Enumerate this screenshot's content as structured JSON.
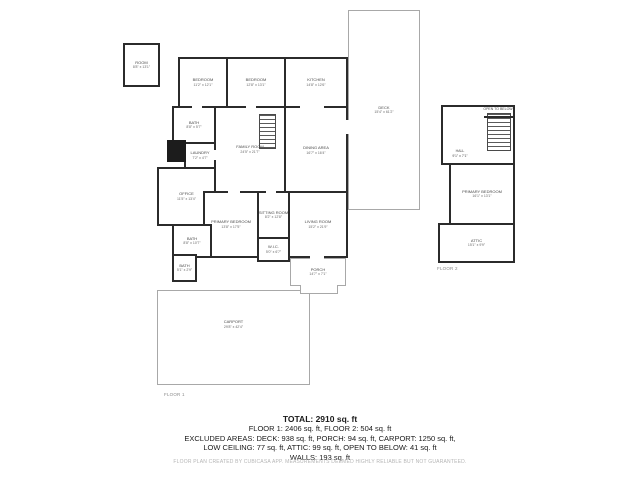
{
  "plan": {
    "floor1_label": "FLOOR 1",
    "floor2_label": "FLOOR 2",
    "rooms": {
      "detached_room": {
        "name": "ROOM",
        "dims": "8'8\" x 13'1\""
      },
      "bedroom_west": {
        "name": "BEDROOM",
        "dims": "11'2\" x 12'1\""
      },
      "bedroom_center": {
        "name": "BEDROOM",
        "dims": "12'8\" x 13'1\""
      },
      "kitchen": {
        "name": "KITCHEN",
        "dims": "14'8\" x 12'6\""
      },
      "bath_top": {
        "name": "BATH",
        "dims": "8'8\" x 5'7\""
      },
      "laundry": {
        "name": "LAUNDRY",
        "dims": "7'2\" x 4'7\""
      },
      "office": {
        "name": "OFFICE",
        "dims": "11'5\" x 13'4\""
      },
      "family_room": {
        "name": "FAMILY ROOM",
        "dims": "24'5\" x 21'7\""
      },
      "dining_area": {
        "name": "DINING AREA",
        "dims": "16'7\" x 16'4\""
      },
      "primary_bedroom": {
        "name": "PRIMARY BEDROOM",
        "dims": "13'8\" x 17'5\""
      },
      "sitting_room": {
        "name": "SITTING ROOM",
        "dims": "8'2\" x 12'8\""
      },
      "wic": {
        "name": "W.I.C.",
        "dims": "5'0\" x 6'7\""
      },
      "living_room": {
        "name": "LIVING ROOM",
        "dims": "15'2\" x 21'9\""
      },
      "bath_lower": {
        "name": "BATH",
        "dims": "8'8\" x 10'7\""
      },
      "bath_small": {
        "name": "BATH",
        "dims": "5'1\" x 2'9\""
      },
      "porch": {
        "name": "PORCH",
        "dims": "14'7\" x 7'1\""
      },
      "carport": {
        "name": "CARPORT",
        "dims": "29'8\" x 42'4\""
      },
      "deck": {
        "name": "DECK",
        "dims": "15'4\" x 61'2\""
      },
      "open_to_below": {
        "name": "OPEN TO BELOW",
        "dims": ""
      },
      "hall": {
        "name": "HALL",
        "dims": "9'1\" x 7'1\""
      },
      "primary_bedroom_2": {
        "name": "PRIMARY BEDROOM",
        "dims": "16'1\" x 13'1\""
      },
      "attic": {
        "name": "ATTIC",
        "dims": "15'1\" x 9'9\""
      }
    }
  },
  "summary": {
    "total": "TOTAL: 2910 sq. ft",
    "lines": [
      "FLOOR 1: 2406 sq. ft, FLOOR 2: 504 sq. ft",
      "EXCLUDED AREAS: DECK: 938 sq. ft, PORCH: 94 sq. ft, CARPORT: 1250 sq. ft,",
      "LOW CEILING: 77 sq. ft, ATTIC: 99 sq. ft, OPEN TO BELOW: 41 sq. ft",
      "WALLS: 193 sq. ft"
    ]
  },
  "disclaimer": "FLOOR PLAN CREATED BY CUBICASA APP. MEASUREMENTS DEEMED HIGHLY RELIABLE BUT NOT GUARANTEED."
}
